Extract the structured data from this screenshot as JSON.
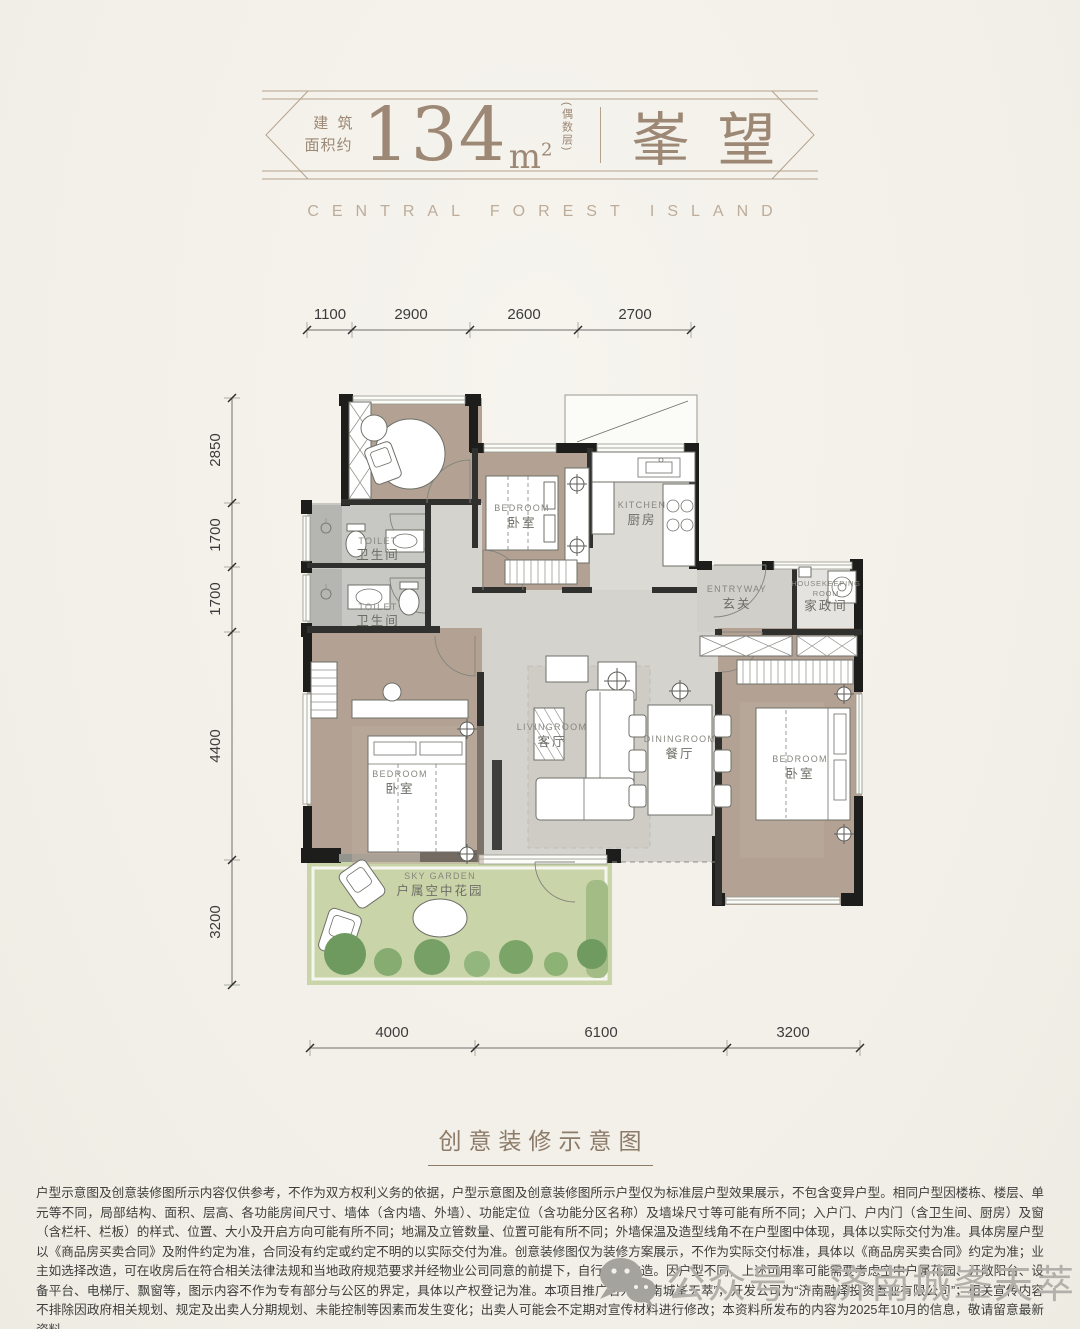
{
  "header": {
    "area_label_line1": "建筑",
    "area_label_line2": "面积约",
    "area_value": "134",
    "area_unit_base": "m",
    "area_unit_exp": "2",
    "floor_note": "(偶数层)",
    "name": "峯望",
    "subtitle": "CENTRAL FOREST ISLAND"
  },
  "plan": {
    "dims_top": [
      "1100",
      "2900",
      "2600",
      "2700"
    ],
    "dims_left": [
      "2850",
      "1700",
      "1700",
      "4400",
      "3200"
    ],
    "dims_bottom": [
      "4000",
      "6100",
      "3200"
    ],
    "rooms": {
      "toilet_upper": {
        "en": "TOILET",
        "cn": "卫生间"
      },
      "toilet_lower": {
        "en": "TOILET",
        "cn": "卫生间"
      },
      "bedroom_top": {
        "en": "BEDROOM",
        "cn": "卧室"
      },
      "kitchen": {
        "en": "KITCHEN",
        "cn": "厨房"
      },
      "entryway": {
        "en": "ENTRYWAY",
        "cn": "玄关"
      },
      "housekeeping": {
        "en1": "HOUSEKEEPING",
        "en2": "ROOM",
        "cn": "家政间"
      },
      "living": {
        "en": "LIVINGROOM",
        "cn": "客厅"
      },
      "dining": {
        "en": "DININGROOM",
        "cn": "餐厅"
      },
      "bedroom_left": {
        "en": "BEDROOM",
        "cn": "卧室"
      },
      "bedroom_right": {
        "en": "BEDROOM",
        "cn": "卧室"
      },
      "sky_garden": {
        "en": "SKY GARDEN",
        "cn": "户属空中花园"
      }
    }
  },
  "caption": "创意装修示意图",
  "disclaimer": "户型示意图及创意装修图所示内容仅供参考，不作为双方权利义务的依据，户型示意图及创意装修图所示户型仅为标准层户型效果展示，不包含变异户型。相同户型因楼栋、楼层、单元等不同，局部结构、面积、层高、各功能房间尺寸、墙体（含内墙、外墙）、功能定位（含功能分区名称）及墙垛尺寸等可能有所不同；入户门、户内门（含卫生间、厨房）及窗（含栏杆、栏板）的样式、位置、大小及开启方向可能有所不同；地漏及立管数量、位置可能有所不同；外墙保温及造型线角不在户型图中体现，具体以实际交付为准。具体房屋户型以《商品房买卖合同》及附件约定为准，合同没有约定或约定不明的以实际交付为准。创意装修图仅为装修方案展示，不作为实际交付标准，具体以《商品房买卖合同》约定为准；业主如选择改造，可在收房后在符合相关法律法规和当地政府规范要求并经物业公司同意的前提下，自行装修改造。因户型不同，上述可用率可能需要考虑空中户属花园、开敞阳台、设备平台、电梯厅、飘窗等，图示内容不作为专有部分与公区的界定，具体以产权登记为准。本项目推广名为“济南城峯天萃”，开发公司为“济南融泽投资置业有限公司”；相关宣传内容不排除因政府相关规划、规定及出卖人分期规划、未能控制等因素而发生变化；出卖人可能会不定期对宣传材料进行修改；本资料所发布的内容为2025年10月的信息，敬请留意最新资料。",
  "watermark": "公众号 · 济南城峯天萃",
  "colors": {
    "accent": "#9c8874",
    "wood": "#b4a496",
    "marble": "#d8d7d2",
    "garden": "#c9d5a8",
    "wall": "#1d1d1c"
  }
}
